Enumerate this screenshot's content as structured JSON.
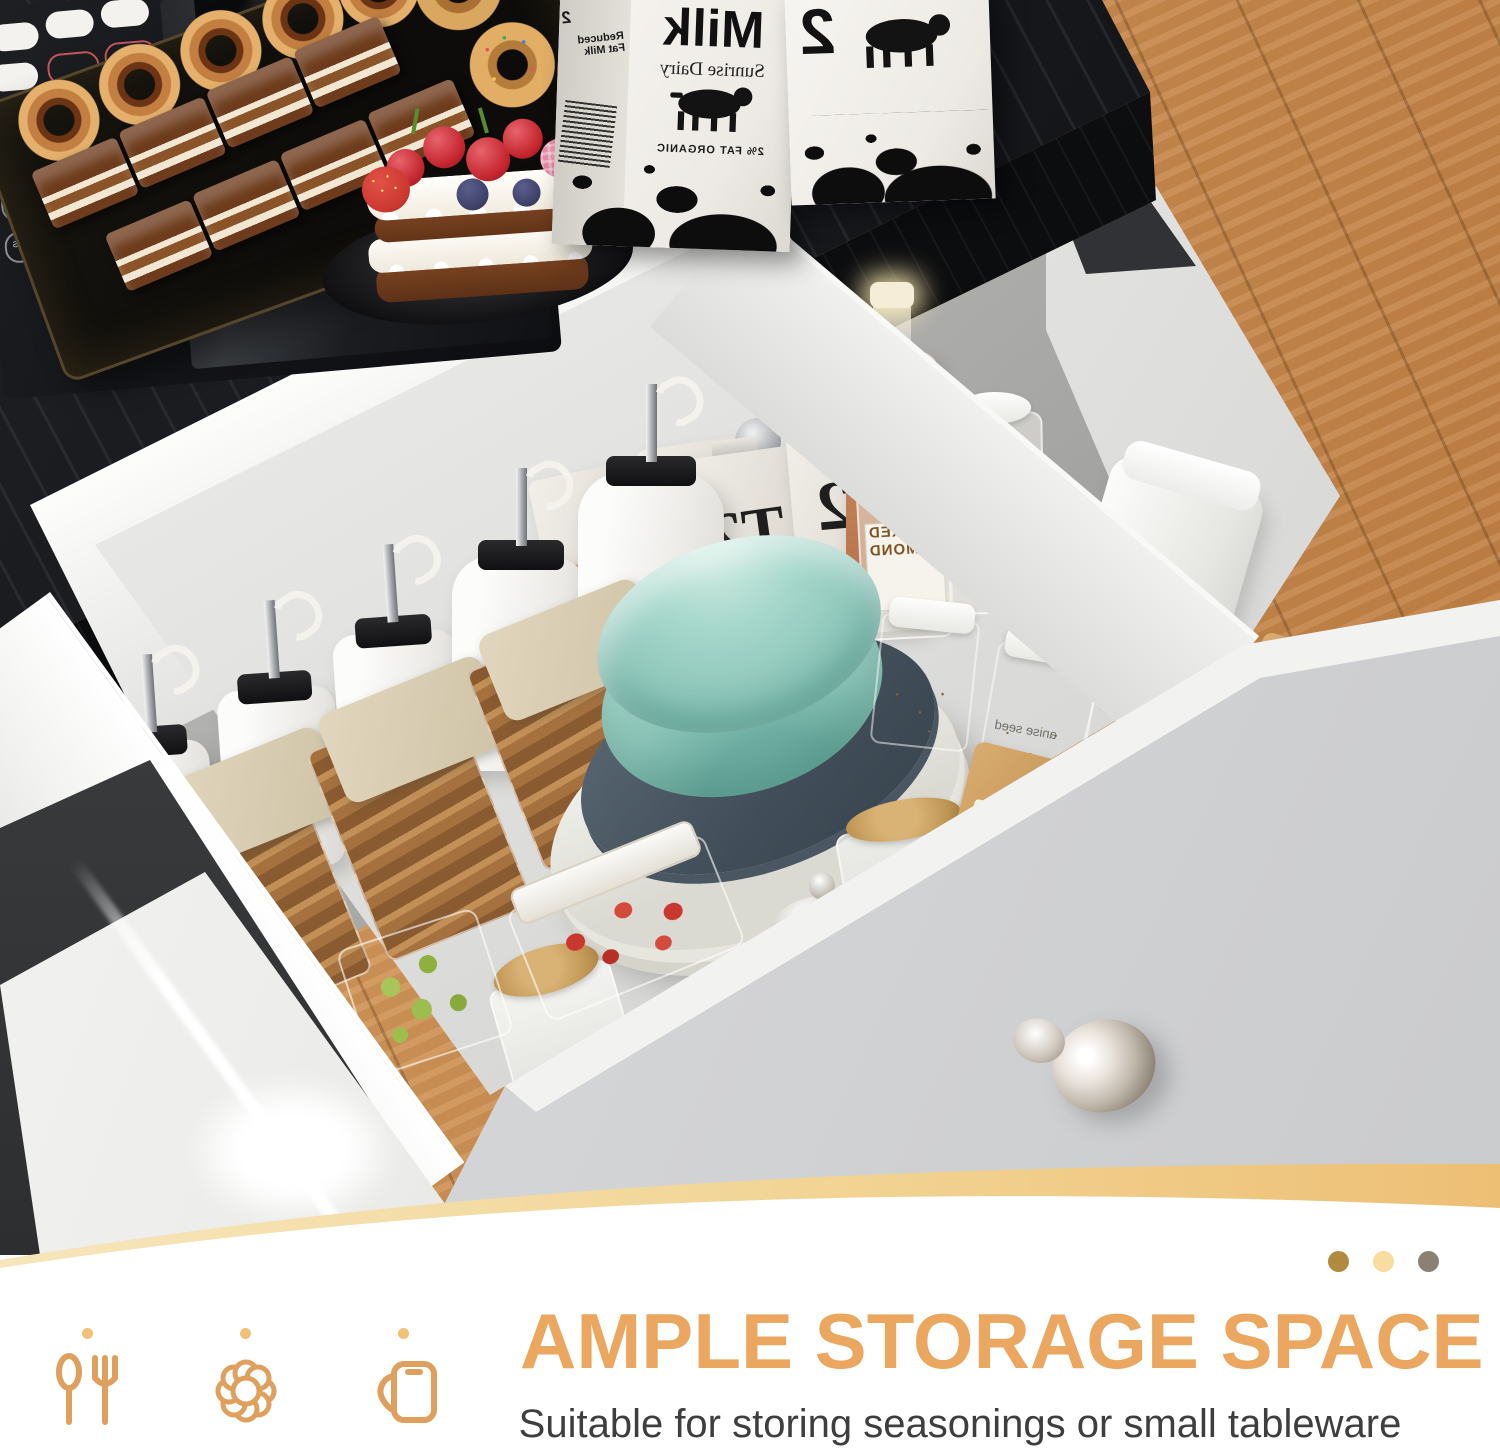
{
  "footer": {
    "heading": "AMPLE STORAGE SPACE",
    "subtitle": "Suitable for storing seasonings or small tableware",
    "accent_color": "#EBA65F",
    "icon_color": "#DFA05E",
    "swoosh_colors": [
      "#F7E6BC",
      "#EDBF75"
    ],
    "dots": [
      {
        "name": "dot-brown",
        "color": "#B08A3E"
      },
      {
        "name": "dot-cream",
        "color": "#F8DCA0"
      },
      {
        "name": "dot-gray",
        "color": "#8A8173"
      }
    ],
    "icons": [
      {
        "name": "utensils-icon"
      },
      {
        "name": "flower-icon"
      },
      {
        "name": "pitcher-icon"
      }
    ]
  },
  "scene": {
    "microwave": {
      "brand": "SAMSUNG",
      "panel_bottom_label": "Power Grill",
      "button_labels": [
        "kg",
        "g",
        "10 min",
        "1 min",
        "+30s"
      ]
    },
    "milk_carton_front": {
      "title": "Milk",
      "subtitle": "Sunrise Dairy",
      "footnote": "2% FAT ORGANIC",
      "side_number": "2",
      "side_text": "Reduced Fat Milk"
    },
    "milk_carton_back": {
      "number": "2"
    },
    "tea_bags": {
      "brand": "T2",
      "label": "TEA"
    },
    "pasta_bag": {
      "brand": "PAS",
      "sub_label": "GNOCCHETTI"
    },
    "bio_bag": {
      "label": "BIO"
    },
    "almond_jars": {
      "line1": "SMOKED",
      "line2": "ALMOND"
    },
    "flour_jar": {
      "label": "flour:"
    },
    "spice_jar_anise": {
      "label": "anise seed"
    },
    "spice_jar_pepper": {
      "label": "pepper mix"
    }
  }
}
